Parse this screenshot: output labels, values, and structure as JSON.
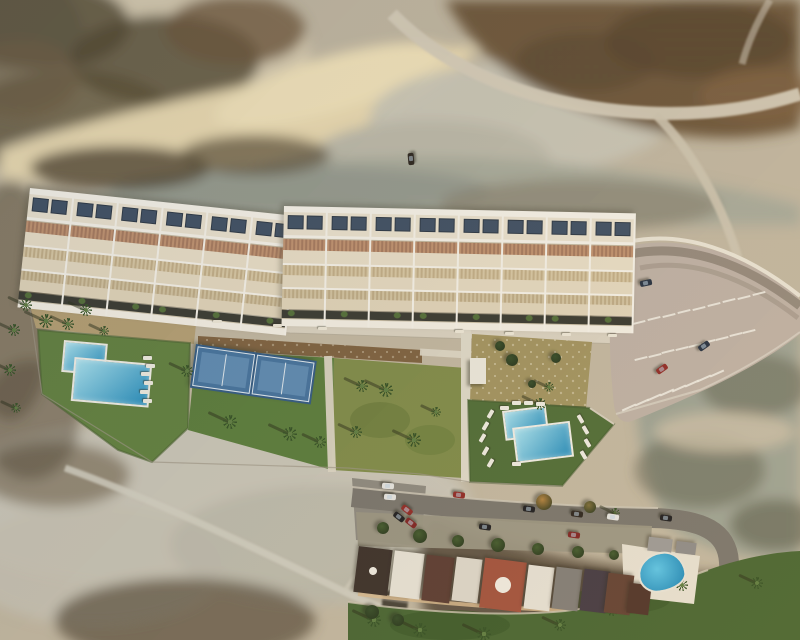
{
  "description": "Aerial drone photograph (architectural render) of a new hillside residential development: a long angled row of white terraced townhouses with rooftop solar panels, pergolas and stepped terraces; communal gardens below with an L-shaped swimming pool on the left, two blue padel courts, palm trees, sun loungers and a second stepped pool on the right; a curved parking area with white bays and a retaining wall on the right; arid desert scrubland with dirt roads above and below; an existing street of houses with parked cars, terracotta and white roofs, lawns, palms and a small kidney pool at the bottom.",
  "palette": {
    "cream": "#ece3cf",
    "creamLight": "#f6f1e5",
    "creamDark": "#e2d5b9",
    "divider": "#f8f4ea",
    "solar": "#3a4b60",
    "solarEdge": "#25313f",
    "pergola": "#c0906c",
    "pergolaDark": "#a5775a",
    "lattice": "#d8c7a2",
    "latticeDark": "#c2ad85",
    "planter": "#33342b",
    "shrub": "#4e6b33",
    "poolRim": "#f2f0e8",
    "water1": "#a8e4f2",
    "water2": "#1d8abc",
    "court": "#3f6f9c",
    "courtInner": "#5e8db6",
    "courtLine": "#dfe9f0",
    "tick": "#efece2",
    "lounger": "#f0ede2",
    "bench": "#efe9d8",
    "palmGreen": "#2e4c1f",
    "palmCore": "#5a7a3c",
    "palmShadow": "rgba(35,40,18,0.5)",
    "carNavy": "#1e2a3c",
    "carRed": "#8e2420",
    "carRed2": "#7c1d1d",
    "carBlack": "#17171a",
    "carWhite": "#e6e6e2",
    "carDark": "#261f18",
    "treeGreen": "#3d5628",
    "treeAutumn": "#b07f3a",
    "treeOlive": "#7a6a35",
    "treeDark": "#2f4722",
    "shed": "#edeade",
    "domeWhite": "#f0ece2",
    "poolKidney1": "#58c5e8",
    "poolKidney2": "#1380b4"
  },
  "unit_rows": [
    {
      "id": "west-row",
      "x": 30,
      "y": 188,
      "rotation": 6,
      "units": 6,
      "unit_width": 43
    },
    {
      "id": "east-row",
      "x": 284,
      "y": 206,
      "rotation": 1.2,
      "units": 8,
      "unit_width": 42
    }
  ],
  "pools": [
    {
      "id": "west-pool",
      "x": 64,
      "y": 340,
      "rotation": 5,
      "rects": [
        [
          0,
          0,
          40,
          28
        ],
        [
          12,
          16,
          74,
          40
        ]
      ]
    },
    {
      "id": "east-pool",
      "x": 502,
      "y": 411,
      "rotation": -7,
      "rects": [
        [
          0,
          0,
          40,
          26
        ],
        [
          8,
          18,
          54,
          32
        ]
      ]
    }
  ],
  "existing_pool": {
    "x": 638,
    "y": 552,
    "w": 44,
    "h": 36,
    "rotation": -8
  },
  "padel_courts": {
    "x": 196,
    "y": 344,
    "rotation": 8,
    "court_w": 56,
    "court_h": 38,
    "count": 2
  },
  "pool_shed": {
    "x": 470,
    "y": 358,
    "w": 16,
    "h": 26
  },
  "palms": [
    [
      26,
      305,
      6
    ],
    [
      46,
      321,
      7
    ],
    [
      68,
      324,
      6
    ],
    [
      86,
      310,
      6
    ],
    [
      104,
      331,
      5
    ],
    [
      187,
      371,
      6
    ],
    [
      230,
      422,
      7
    ],
    [
      290,
      434,
      7
    ],
    [
      320,
      442,
      6
    ],
    [
      362,
      386,
      6
    ],
    [
      386,
      390,
      7
    ],
    [
      356,
      432,
      6
    ],
    [
      414,
      440,
      7
    ],
    [
      436,
      412,
      5
    ],
    [
      540,
      404,
      6
    ],
    [
      549,
      387,
      5
    ],
    [
      14,
      330,
      6
    ],
    [
      10,
      370,
      6
    ],
    [
      16,
      408,
      5
    ],
    [
      374,
      620,
      7
    ],
    [
      420,
      630,
      7
    ],
    [
      484,
      634,
      7
    ],
    [
      560,
      625,
      6
    ],
    [
      612,
      610,
      6
    ],
    [
      682,
      585,
      6
    ],
    [
      757,
      583,
      6
    ],
    [
      615,
      513,
      5
    ]
  ],
  "loungers": [
    [
      143,
      356,
      0
    ],
    [
      146,
      364,
      0
    ],
    [
      141,
      372,
      0
    ],
    [
      144,
      381,
      0
    ],
    [
      140,
      390,
      0
    ],
    [
      143,
      399,
      0
    ],
    [
      512,
      401,
      0
    ],
    [
      524,
      401,
      0
    ],
    [
      536,
      402,
      0
    ],
    [
      500,
      406,
      0
    ],
    [
      576,
      417,
      60
    ],
    [
      581,
      428,
      60
    ],
    [
      583,
      441,
      60
    ],
    [
      579,
      453,
      60
    ],
    [
      486,
      412,
      120
    ],
    [
      481,
      424,
      120
    ],
    [
      478,
      436,
      120
    ],
    [
      481,
      449,
      120
    ],
    [
      486,
      461,
      120
    ],
    [
      512,
      462,
      0
    ]
  ],
  "benches": [
    [
      213,
      320
    ],
    [
      273,
      324
    ],
    [
      318,
      327
    ],
    [
      455,
      330
    ],
    [
      505,
      332
    ],
    [
      562,
      333
    ],
    [
      608,
      334
    ]
  ],
  "cars": [
    [
      405,
      156,
      85,
      "carDark"
    ],
    [
      640,
      280,
      -12,
      "carNavy"
    ],
    [
      698,
      343,
      -35,
      "carNavy"
    ],
    [
      656,
      366,
      -35,
      "carRed"
    ],
    [
      382,
      483,
      3,
      "carWhite"
    ],
    [
      384,
      494,
      3,
      "carWhite"
    ],
    [
      401,
      507,
      38,
      "carRed"
    ],
    [
      393,
      514,
      38,
      "carBlack"
    ],
    [
      405,
      520,
      38,
      "carRed2"
    ],
    [
      453,
      492,
      7,
      "carRed"
    ],
    [
      479,
      524,
      8,
      "carBlack"
    ],
    [
      523,
      506,
      8,
      "carBlack"
    ],
    [
      571,
      511,
      8,
      "carDark"
    ],
    [
      607,
      514,
      8,
      "carWhite"
    ],
    [
      568,
      532,
      8,
      "carRed2"
    ],
    [
      660,
      515,
      8,
      "carBlack"
    ]
  ],
  "parking_rows": [
    {
      "from": [
        638,
        316
      ],
      "to": [
        758,
        287
      ],
      "count": 9,
      "len": 13,
      "angle": 76
    },
    {
      "from": [
        640,
        352
      ],
      "to": [
        748,
        325
      ],
      "count": 9,
      "len": 13,
      "angle": 76
    },
    {
      "from": [
        628,
        400
      ],
      "to": [
        716,
        366
      ],
      "count": 8,
      "len": 15,
      "angle": 66
    }
  ],
  "street_trees": [
    [
      383,
      528,
      6,
      "treeGreen"
    ],
    [
      420,
      536,
      7,
      "treeGreen"
    ],
    [
      458,
      541,
      6,
      "treeGreen"
    ],
    [
      498,
      545,
      7,
      "treeGreen"
    ],
    [
      538,
      549,
      6,
      "treeGreen"
    ],
    [
      578,
      552,
      6,
      "treeGreen"
    ],
    [
      614,
      555,
      5,
      "treeGreen"
    ],
    [
      544,
      502,
      8,
      "treeAutumn"
    ],
    [
      590,
      507,
      6,
      "treeOlive"
    ],
    [
      372,
      612,
      7,
      "treeDark"
    ],
    [
      398,
      620,
      6,
      "treeDark"
    ],
    [
      500,
      346,
      5,
      "treeDark"
    ],
    [
      512,
      360,
      6,
      "treeDark"
    ],
    [
      556,
      358,
      5,
      "treeDark"
    ],
    [
      532,
      384,
      4,
      "treeDark"
    ]
  ],
  "house_roofs": [
    [
      356,
      548,
      34,
      46,
      "#352a24",
      7,
      4
    ],
    [
      392,
      552,
      30,
      46,
      "#e8e3d7",
      7,
      0
    ],
    [
      424,
      556,
      28,
      46,
      "#56362c",
      7,
      0
    ],
    [
      454,
      558,
      26,
      44,
      "#ddd7ca",
      7,
      0
    ],
    [
      482,
      560,
      42,
      50,
      "#a04d38",
      7,
      8
    ],
    [
      526,
      566,
      26,
      44,
      "#e6e1d5",
      7,
      0
    ],
    [
      554,
      568,
      26,
      42,
      "#7e7a74",
      7,
      0
    ],
    [
      582,
      570,
      26,
      42,
      "#3e343e",
      7,
      0
    ],
    [
      606,
      574,
      26,
      40,
      "#5e3c2e",
      7,
      0
    ],
    [
      628,
      584,
      22,
      30,
      "#4a2e24",
      7,
      0
    ],
    [
      648,
      538,
      24,
      14,
      "#9a9895",
      7,
      0
    ],
    [
      676,
      542,
      20,
      12,
      "#8b8987",
      7,
      0
    ]
  ]
}
